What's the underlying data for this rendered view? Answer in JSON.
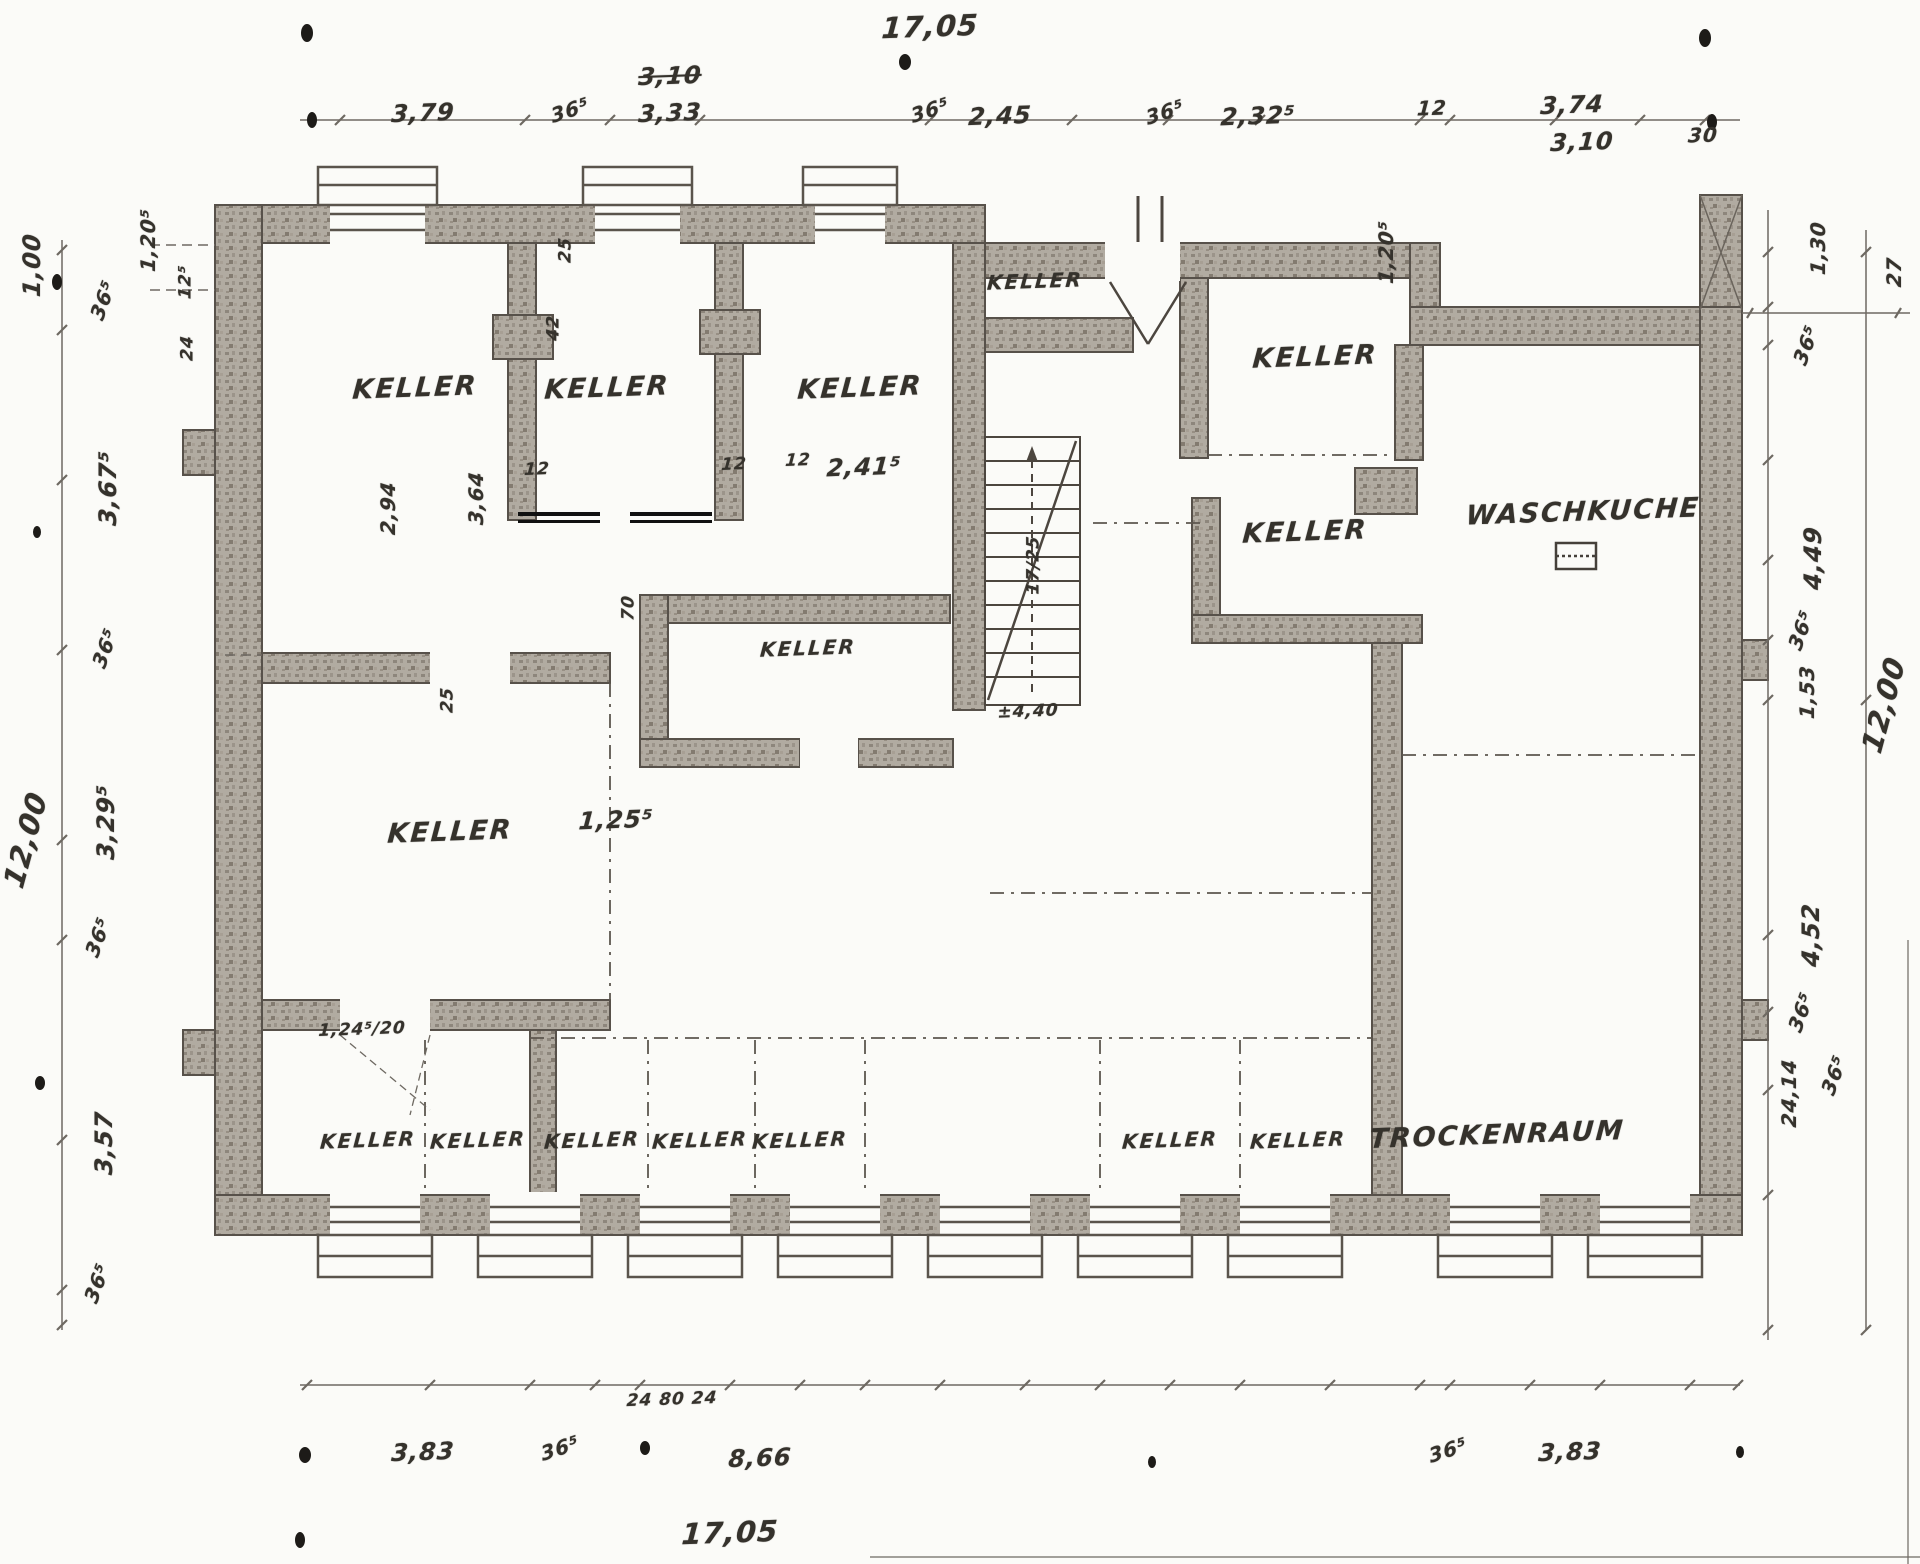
{
  "plan_title": "Kellergeschoss",
  "rooms": [
    {
      "t": "KELLER"
    },
    {
      "t": "KELLER"
    },
    {
      "t": "KELLER"
    },
    {
      "t": "KELLER"
    },
    {
      "t": "KELLER"
    },
    {
      "t": "KELLER"
    },
    {
      "t": "KELLER"
    },
    {
      "t": "KELLER"
    },
    {
      "t": "KELLER"
    },
    {
      "t": "KELLER"
    },
    {
      "t": "KELLER"
    },
    {
      "t": "KELLER"
    },
    {
      "t": "KELLER"
    },
    {
      "t": "KELLER"
    },
    {
      "t": "KELLER"
    },
    {
      "t": "WASCHKUCHE"
    },
    {
      "t": "TROCKENRAUM"
    }
  ],
  "dims_top": [
    {
      "t": "17,05"
    },
    {
      "t": "3,79"
    },
    {
      "t": "36⁵"
    },
    {
      "t": "3,10"
    },
    {
      "t": "3,33"
    },
    {
      "t": "36⁵"
    },
    {
      "t": "2,45"
    },
    {
      "t": "36⁵"
    },
    {
      "t": "2,32⁵"
    },
    {
      "t": "12"
    },
    {
      "t": "3,74"
    },
    {
      "t": "3,10"
    },
    {
      "t": "30"
    }
  ],
  "dims_left": [
    {
      "t": "1,00"
    },
    {
      "t": "1,20⁵"
    },
    {
      "t": "36⁵"
    },
    {
      "t": "12⁵"
    },
    {
      "t": "24"
    },
    {
      "t": "3,67⁵"
    },
    {
      "t": "36⁵"
    },
    {
      "t": "12,00"
    },
    {
      "t": "3,29⁵"
    },
    {
      "t": "36⁵"
    },
    {
      "t": "3,57"
    },
    {
      "t": "36⁵"
    }
  ],
  "dims_right": [
    {
      "t": "1,20⁵"
    },
    {
      "t": "1,30"
    },
    {
      "t": "27"
    },
    {
      "t": "36⁵"
    },
    {
      "t": "4,49"
    },
    {
      "t": "36⁵"
    },
    {
      "t": "1,53"
    },
    {
      "t": "12,00"
    },
    {
      "t": "4,52"
    },
    {
      "t": "36⁵"
    },
    {
      "t": "24,14"
    },
    {
      "t": "36⁵"
    }
  ],
  "dims_bottom": [
    {
      "t": "24  80  24"
    },
    {
      "t": "3,83"
    },
    {
      "t": "36⁵"
    },
    {
      "t": "8,66"
    },
    {
      "t": "36⁵"
    },
    {
      "t": "3,83"
    },
    {
      "t": "17,05"
    }
  ],
  "dims_interior": [
    {
      "t": "2,94"
    },
    {
      "t": "3,64"
    },
    {
      "t": "12"
    },
    {
      "t": "42"
    },
    {
      "t": "25"
    },
    {
      "t": "12"
    },
    {
      "t": "2,41⁵"
    },
    {
      "t": "12"
    },
    {
      "t": "70"
    },
    {
      "t": "25"
    },
    {
      "t": "1,25⁵"
    },
    {
      "t": "1,24⁵/20"
    },
    {
      "t": "±4,40"
    },
    {
      "t": "17/25"
    }
  ]
}
